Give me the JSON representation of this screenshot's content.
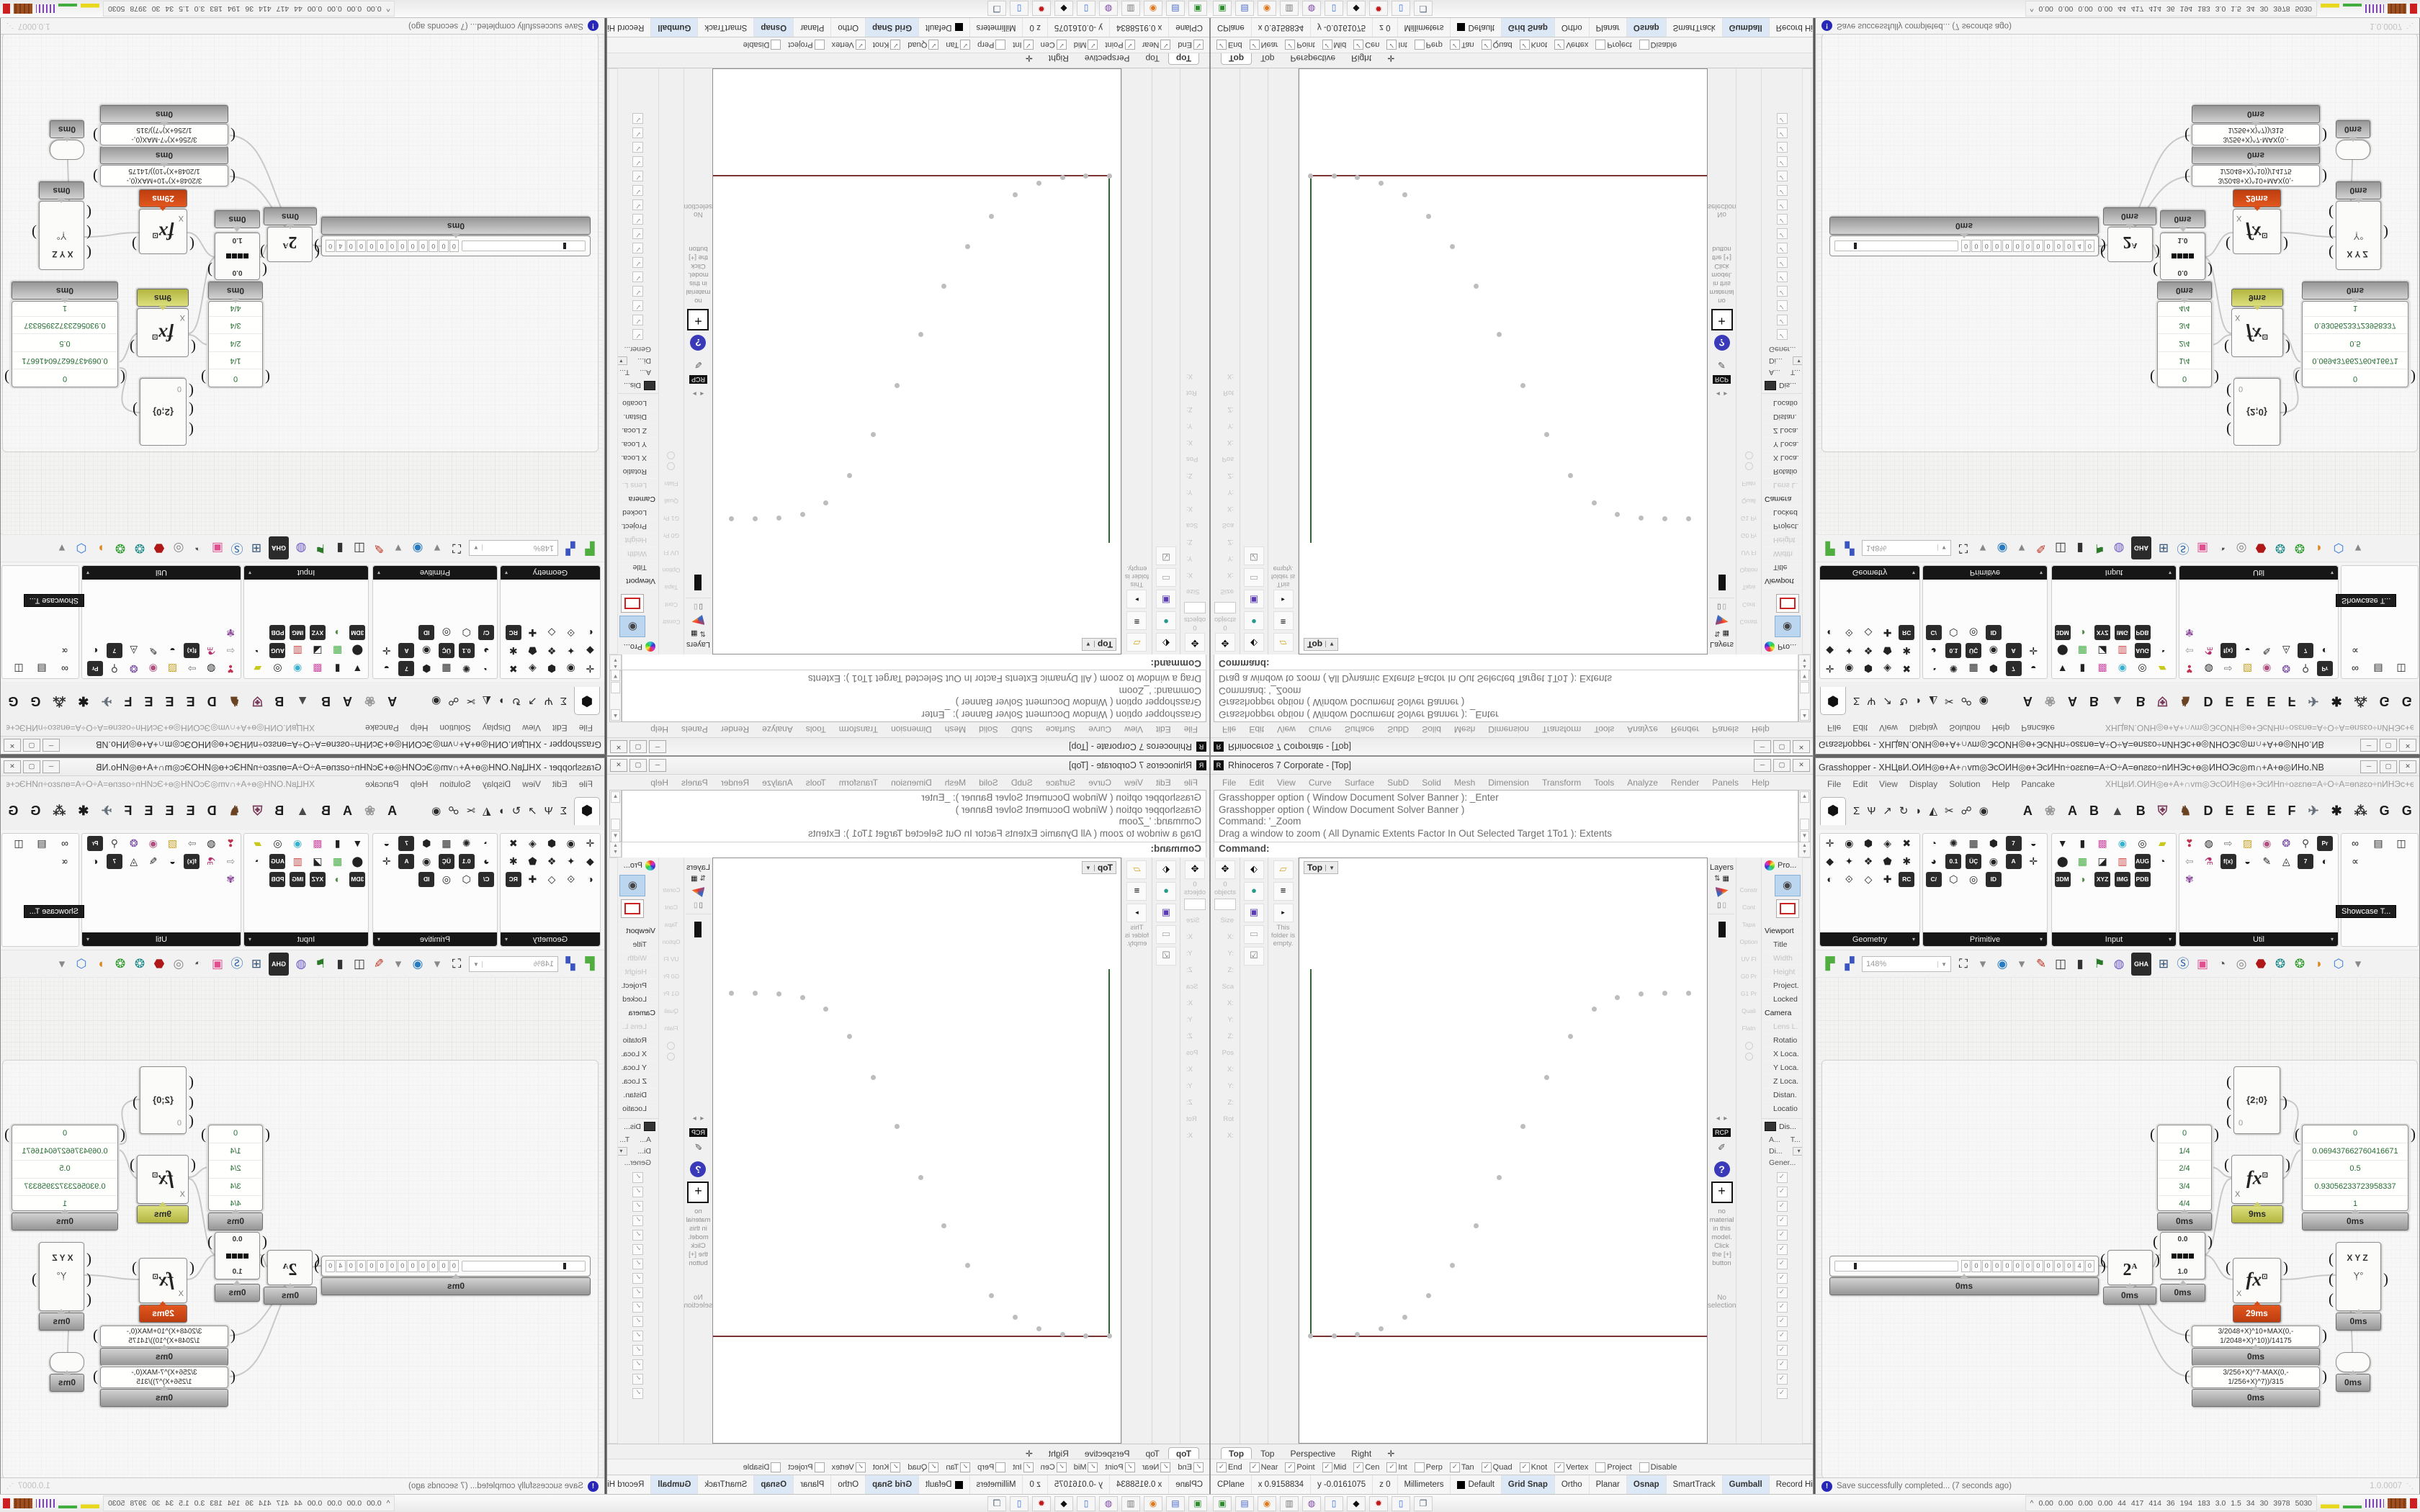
{
  "chrome": {
    "min": "─",
    "max": "▢",
    "close": "✕"
  },
  "rhino": {
    "title": "Rhinoceros 7 Corporate - [Top]",
    "menu": [
      "File",
      "Edit",
      "View",
      "Curve",
      "Surface",
      "SubD",
      "Solid",
      "Mesh",
      "Dimension",
      "Transform",
      "Tools",
      "Analyze",
      "Render",
      "Panels",
      "Help"
    ],
    "command_history": [
      "Grasshopper option ( Window  Document  Solver  Banner ): _Enter",
      "Grasshopper option ( Window  Document  Solver  Banner )",
      "Command: '_Zoom",
      "Drag a window to zoom ( All  Dynamic  Extents  Factor  In  Out  Selected  Target  1To1 ):  Extents"
    ],
    "command_prompt": "Command:",
    "left": {
      "objects_label": "0 objects",
      "boxedit_rows": [
        {
          "t": "Size",
          "h": true
        },
        {
          "t": "X:"
        },
        {
          "t": "Y:"
        },
        {
          "t": "Z:"
        },
        {
          "t": "Sca",
          "h": true
        },
        {
          "t": "X:"
        },
        {
          "t": "Y:"
        },
        {
          "t": "Z:"
        },
        {
          "t": "Pos",
          "h": true
        },
        {
          "t": "X:"
        },
        {
          "t": "Y:"
        },
        {
          "t": "Z:"
        },
        {
          "t": "Rot",
          "h": true
        },
        {
          "t": "X:"
        }
      ],
      "col2_icons": [
        {
          "g": "⬖",
          "c": "#111111"
        },
        {
          "g": "●",
          "c": "#2a9a8a"
        },
        {
          "g": "▣",
          "c": "#5a3ab0"
        },
        {
          "g": "▭",
          "c": "#aaaaaa"
        },
        {
          "g": "☑",
          "c": "#777777"
        }
      ],
      "col3_icons": [
        {
          "g": "▱",
          "c": "#d8a62a"
        },
        {
          "g": "≡",
          "c": "#111111"
        },
        {
          "g": "▸",
          "c": "#555555"
        }
      ],
      "folder_note": "This folder is empty."
    },
    "viewport": {
      "label": "Top",
      "dropdown": "▼"
    },
    "viewport_tabs": [
      {
        "label": "Top",
        "active": true
      },
      {
        "label": "Top"
      },
      {
        "label": "Perspective"
      },
      {
        "label": "Right"
      },
      {
        "label": "✛"
      }
    ],
    "layers": {
      "title": "Layers",
      "icons": [
        {
          "g": "⇅",
          "c": "#444444"
        },
        {
          "g": "▦",
          "c": "#111111"
        }
      ],
      "pager_left": "◂",
      "pager_right": "▸",
      "rcp": "RCP",
      "help": "?",
      "plus": "+",
      "material_note": "no material in this model. Click the [+] button",
      "no_selection": "No selection"
    },
    "constr": {
      "labels": [
        "Constr",
        "Cont",
        "Tapa",
        "Option",
        "UV Fl",
        "G0 Pr",
        "G1 Pr",
        "Quali",
        "Flatn"
      ]
    },
    "props": {
      "title": "Pro...",
      "rows": [
        {
          "label": "Viewport",
          "sect": true
        },
        {
          "label": "Title"
        },
        {
          "label": "Width",
          "dim": true
        },
        {
          "label": "Height",
          "dim": true
        },
        {
          "label": "Project."
        },
        {
          "label": "Locked"
        },
        {
          "label": "Camera",
          "sect": true
        },
        {
          "label": "Lens L.",
          "dim": true
        },
        {
          "label": "Rotatio"
        },
        {
          "label": "X Loca."
        },
        {
          "label": "Y Loca."
        },
        {
          "label": "Z Loca."
        },
        {
          "label": "Distan."
        },
        {
          "label": "Locatio"
        }
      ]
    },
    "display": {
      "title": "Dis...",
      "col_a": "A...",
      "col_b": "T...",
      "row_a": "Di...",
      "row_b": "Gener...",
      "dd": "▾",
      "checks": [
        "✓",
        "✓",
        "✓",
        "✓",
        "✓",
        "✓",
        "✓",
        "✓",
        "✓",
        "✓",
        "✓",
        "✓",
        "✓",
        "✓",
        "✓",
        "✓"
      ]
    },
    "osnap": [
      {
        "label": "End",
        "on": true
      },
      {
        "label": "Near",
        "on": true
      },
      {
        "label": "Point",
        "on": true
      },
      {
        "label": "Mid",
        "on": true
      },
      {
        "label": "Cen",
        "on": true
      },
      {
        "label": "Int",
        "on": true
      },
      {
        "label": "Perp"
      },
      {
        "label": "Tan",
        "on": true
      },
      {
        "label": "Quad",
        "on": true
      },
      {
        "label": "Knot",
        "on": true
      },
      {
        "label": "Vertex",
        "on": true
      },
      {
        "label": "Project"
      },
      {
        "label": "Disable"
      }
    ],
    "status": [
      {
        "t": "CPlane"
      },
      {
        "t": "x 0.9158834"
      },
      {
        "t": "y -0.0161075"
      },
      {
        "t": "z 0"
      },
      {
        "t": "Millimeters"
      },
      {
        "t": "Default",
        "swatch": true
      },
      {
        "t": "Grid Snap",
        "on": true
      },
      {
        "t": "Ortho"
      },
      {
        "t": "Planar"
      },
      {
        "t": "Osnap",
        "on": true
      },
      {
        "t": "SmartTrack"
      },
      {
        "t": "Gumball",
        "on": true
      },
      {
        "t": "Record History"
      },
      {
        "t": "Filter"
      }
    ]
  },
  "gh": {
    "title": "Grasshopper - XHЦвИ.ОИН◎ѳ+А+∩vm◎ЭсОИН◎ѳ+ЭсИНn÷оƨɛnѳ=А÷О÷А=ѳnƨɛо÷nИНЭс+ѳ◎ИНОЭс◎m∩+А+ѳ◎ИНо.NB",
    "menu": [
      "File",
      "Edit",
      "View",
      "Display",
      "Solution",
      "Help",
      "Pancake"
    ],
    "doc_code": "XHЦвИ.ОИН◎ѳ+А+∩vm◎ЭсОИН◎ѳ+ЭсИНn÷оƨɛnѳ=А÷О÷А=ѳnƨɛо÷nИНЭс+ѳ◎ИНОЭс◎m∩+А+ѳ◎ИНо.NB",
    "tab_icons": [
      {
        "g": "⬢",
        "sel": true
      },
      {
        "g": "Σ"
      },
      {
        "g": "Ѱ"
      },
      {
        "g": "↗"
      },
      {
        "g": "↻"
      },
      {
        "g": "◗"
      },
      {
        "g": "◭"
      },
      {
        "g": "✂"
      },
      {
        "g": "☍"
      },
      {
        "g": "◉"
      }
    ],
    "tab_letters": [
      {
        "g": "A"
      },
      {
        "g": "❀",
        "c": "#9a9a9a"
      },
      {
        "g": "A"
      },
      {
        "g": "B"
      },
      {
        "g": "▲",
        "c": "#4a4a4a"
      },
      {
        "g": "B"
      },
      {
        "g": "⛨",
        "c": "#7a3a5a"
      },
      {
        "g": "♞",
        "c": "#6a4422"
      },
      {
        "g": "D"
      },
      {
        "g": "E"
      },
      {
        "g": "E"
      },
      {
        "g": "E"
      },
      {
        "g": "F"
      },
      {
        "g": "✈",
        "c": "#66707a"
      },
      {
        "g": "✱",
        "c": "#1a1a1a"
      },
      {
        "g": "⁂",
        "c": "#333333"
      },
      {
        "g": "G"
      },
      {
        "g": "G"
      }
    ],
    "sections": [
      {
        "label": "Geometry",
        "icons": [
          {
            "g": "✛"
          },
          {
            "g": "◉"
          },
          {
            "g": "⬢"
          },
          {
            "g": "◈"
          },
          {
            "g": "✖"
          },
          {
            "g": "◆"
          },
          {
            "g": "✦"
          },
          {
            "g": "❖"
          },
          {
            "g": "⬟"
          },
          {
            "g": "✱"
          },
          {
            "g": "◐"
          },
          {
            "g": "⟐"
          },
          {
            "g": "◇"
          },
          {
            "g": "✚"
          },
          {
            "g": "RC",
            "chip": true
          }
        ]
      },
      {
        "label": "Primitive",
        "icons": [
          {
            "g": "◔"
          },
          {
            "g": "✺"
          },
          {
            "g": "▦"
          },
          {
            "g": "⬢"
          },
          {
            "g": "7",
            "chip": true
          },
          {
            "g": "◒"
          },
          {
            "g": "◕"
          },
          {
            "g": "0.1",
            "chip": true
          },
          {
            "g": "ÜÇ",
            "chip": true
          },
          {
            "g": "◉"
          },
          {
            "g": "A",
            "chip": true
          },
          {
            "g": "✛"
          },
          {
            "g": "C/",
            "chip": true
          },
          {
            "g": "⬡"
          },
          {
            "g": "◎"
          },
          {
            "g": "ID",
            "chip": true
          }
        ]
      },
      {
        "label": "Input",
        "icons": [
          {
            "g": "▼"
          },
          {
            "g": "▮"
          },
          {
            "g": "▩",
            "c": "#d04fa8"
          },
          {
            "g": "◉",
            "c": "#3ab0d0"
          },
          {
            "g": "◎"
          },
          {
            "g": "▰",
            "c": "#c8c820"
          },
          {
            "g": "⬤"
          },
          {
            "g": "▦",
            "c": "#3fae3f"
          },
          {
            "g": "◪"
          },
          {
            "g": "▥",
            "c": "#cc4444"
          },
          {
            "g": "AUG",
            "chip": true
          },
          {
            "g": "◔"
          },
          {
            "g": "3DM",
            "chip": true
          },
          {
            "g": "◑",
            "c": "#4a8a3a"
          },
          {
            "g": "XYZ",
            "chip": true
          },
          {
            "g": "IMG",
            "chip": true
          },
          {
            "g": "PDB",
            "chip": true
          }
        ]
      },
      {
        "label": "Util",
        "icons": [
          {
            "g": "❣",
            "c": "#c03050"
          },
          {
            "g": "◍"
          },
          {
            "g": "⇨",
            "c": "#777777"
          },
          {
            "g": "▨",
            "c": "#caa020"
          },
          {
            "g": "◉",
            "c": "#b05080"
          },
          {
            "g": "❂",
            "c": "#7040a0"
          },
          {
            "g": "⚲",
            "c": "#444444"
          },
          {
            "g": "Pr",
            "chip": true
          },
          {
            "g": "⇦",
            "c": "#999999"
          },
          {
            "g": "⚗",
            "c": "#b03070"
          },
          {
            "g": "f(x)",
            "chip": true
          },
          {
            "g": "◒"
          },
          {
            "g": "✎"
          },
          {
            "g": "◬"
          },
          {
            "g": "7",
            "chip": true
          },
          {
            "g": "◐"
          },
          {
            "g": "✾",
            "c": "#884499"
          }
        ]
      },
      {
        "label": "Showcase",
        "icons": [
          {
            "g": "∞"
          },
          {
            "g": "▤"
          },
          {
            "g": "◫"
          },
          {
            "g": "∝"
          }
        ]
      }
    ],
    "showcase_tooltip": "Showcase T...",
    "zoom_level": "148%",
    "toolbar_icons": [
      {
        "g": "▛",
        "c": "#4fae3f"
      },
      {
        "g": "▞",
        "c": "#3a55c0"
      }
    ],
    "toolbar_icons2": [
      {
        "g": "⛶",
        "c": "#111111"
      },
      {
        "g": "▾",
        "c": "#888888"
      },
      {
        "g": "◉",
        "c": "#2a7ac0"
      },
      {
        "g": "▾",
        "c": "#888888"
      },
      {
        "g": "✎",
        "c": "#c03020"
      },
      {
        "g": "◫",
        "c": "#333333"
      },
      {
        "g": "▮",
        "c": "#333333"
      },
      {
        "g": "⚑",
        "c": "#2a7a2a"
      },
      {
        "g": "◍",
        "c": "#6a5acd"
      },
      {
        "g": "GHA",
        "chip": true
      },
      {
        "g": "⊞",
        "c": "#335577"
      },
      {
        "g": "Ⓢ",
        "c": "#2a66aa"
      },
      {
        "g": "▣",
        "c": "#e05090"
      },
      {
        "g": "◔",
        "c": "#555555"
      },
      {
        "g": "◎",
        "c": "#888888"
      },
      {
        "g": "⬣",
        "c": "#b01818"
      },
      {
        "g": "❂",
        "c": "#1d8a8a"
      },
      {
        "g": "❂",
        "c": "#2a9a2a"
      },
      {
        "g": "◗",
        "c": "#dd8822"
      },
      {
        "g": "⬡",
        "c": "#3377dd"
      },
      {
        "g": "▾",
        "c": "#888888"
      }
    ],
    "canvas": {
      "slider": {
        "cells": [
          "0",
          "0",
          "0",
          "0",
          "0",
          "0",
          "0",
          "0",
          "0",
          "0",
          "0",
          "4",
          "0"
        ],
        "badge": "0ms"
      },
      "pow": {
        "base": "2",
        "exp": "A",
        "badge": "0ms"
      },
      "graph": {
        "top": "0.0",
        "bottom": "1.0",
        "badge": "0ms"
      },
      "panel_a": {
        "rows": [
          "0",
          "1/4",
          "2/4",
          "3/4",
          "4/4"
        ],
        "badge": "0ms"
      },
      "panel_b": {
        "rows": [
          "0",
          "0.069437662760416671",
          "0.5",
          "0.93056233723958337",
          "1"
        ],
        "badge": "0ms"
      },
      "fx1": {
        "label": "fx",
        "sup": "⊡",
        "input": "X",
        "badge": "9ms"
      },
      "fx2": {
        "label": "fx",
        "sup": "⊡",
        "input": "X",
        "badge": "29ms"
      },
      "path_node": {
        "label": "{2;0}",
        "sub": "0"
      },
      "xyz": {
        "label": "XYZ",
        "sub": "Ỵ°",
        "badge": "0ms"
      },
      "expr1": {
        "line1": "3/2048+X)^10+MAX(0,-",
        "line2": "1/2048+X)^10))/14175",
        "badge": "0ms"
      },
      "expr2": {
        "line1": "3/256+X)^7-MAX(0,-",
        "line2": "1/256+X)^7))/315",
        "badge": "0ms"
      },
      "relay": {
        "badge": "0ms"
      }
    },
    "statusbar": {
      "text": "Save successfully completed... (7 seconds ago)",
      "version": "1.0.0007",
      "grip": "⋱"
    }
  },
  "taskbar": {
    "icons": [
      {
        "g": "▣",
        "c": "#2e8b2e"
      },
      {
        "g": "▤",
        "c": "#4466cc"
      },
      {
        "g": "◉",
        "c": "#e07820"
      },
      {
        "g": "▥",
        "c": "#777777"
      },
      {
        "g": "◍",
        "c": "#7a3fa0"
      },
      {
        "g": "▯",
        "c": "#3a6fd8"
      },
      {
        "g": "◆",
        "c": "#111111"
      },
      {
        "g": "✹",
        "c": "#c01818"
      },
      {
        "g": "▯",
        "c": "#3a6fd8"
      },
      {
        "g": "❐",
        "c": "#556677"
      }
    ],
    "tray_toggle": "^",
    "tray_numbers": [
      "0.00",
      "0.00",
      "0.00",
      "0.00",
      "44",
      "417",
      "414",
      "36",
      "194",
      "183",
      "3.0",
      "1.5",
      "34",
      "30",
      "3978",
      "5030"
    ]
  },
  "chart_data": {
    "type": "scatter",
    "title": "Point set in Rhino Top viewport (smoothstep-like ogive rising from origin to plateau)",
    "xlabel": "x",
    "ylabel": "y",
    "legend": false,
    "grid": false,
    "x_axis_color": "#7a3434",
    "y_axis_color": "#2d6a2d",
    "x_norm": [
      0,
      0.0625,
      0.125,
      0.1875,
      0.25,
      0.3125,
      0.375,
      0.4375,
      0.5,
      0.5625,
      0.625,
      0.6875,
      0.75,
      0.8125,
      0.875,
      0.9375,
      1.0
    ],
    "y_values": [
      0,
      0,
      0.003,
      0.02,
      0.055,
      0.115,
      0.205,
      0.32,
      0.46,
      0.61,
      0.755,
      0.875,
      0.955,
      0.99,
      0.998,
      1.0,
      1.0
    ],
    "points": [
      {
        "x": 2.6,
        "y": 81.6
      },
      {
        "x": 8.4,
        "y": 81.6
      },
      {
        "x": 14.2,
        "y": 81.4
      },
      {
        "x": 20.0,
        "y": 80.4
      },
      {
        "x": 25.8,
        "y": 78.4
      },
      {
        "x": 31.6,
        "y": 74.8
      },
      {
        "x": 37.4,
        "y": 69.6
      },
      {
        "x": 43.2,
        "y": 62.8
      },
      {
        "x": 49.0,
        "y": 54.6
      },
      {
        "x": 54.8,
        "y": 45.8
      },
      {
        "x": 60.6,
        "y": 37.4
      },
      {
        "x": 66.4,
        "y": 30.4
      },
      {
        "x": 72.2,
        "y": 25.8
      },
      {
        "x": 78.0,
        "y": 23.8
      },
      {
        "x": 83.8,
        "y": 23.2
      },
      {
        "x": 89.6,
        "y": 23.0
      },
      {
        "x": 95.4,
        "y": 23.0
      }
    ]
  }
}
